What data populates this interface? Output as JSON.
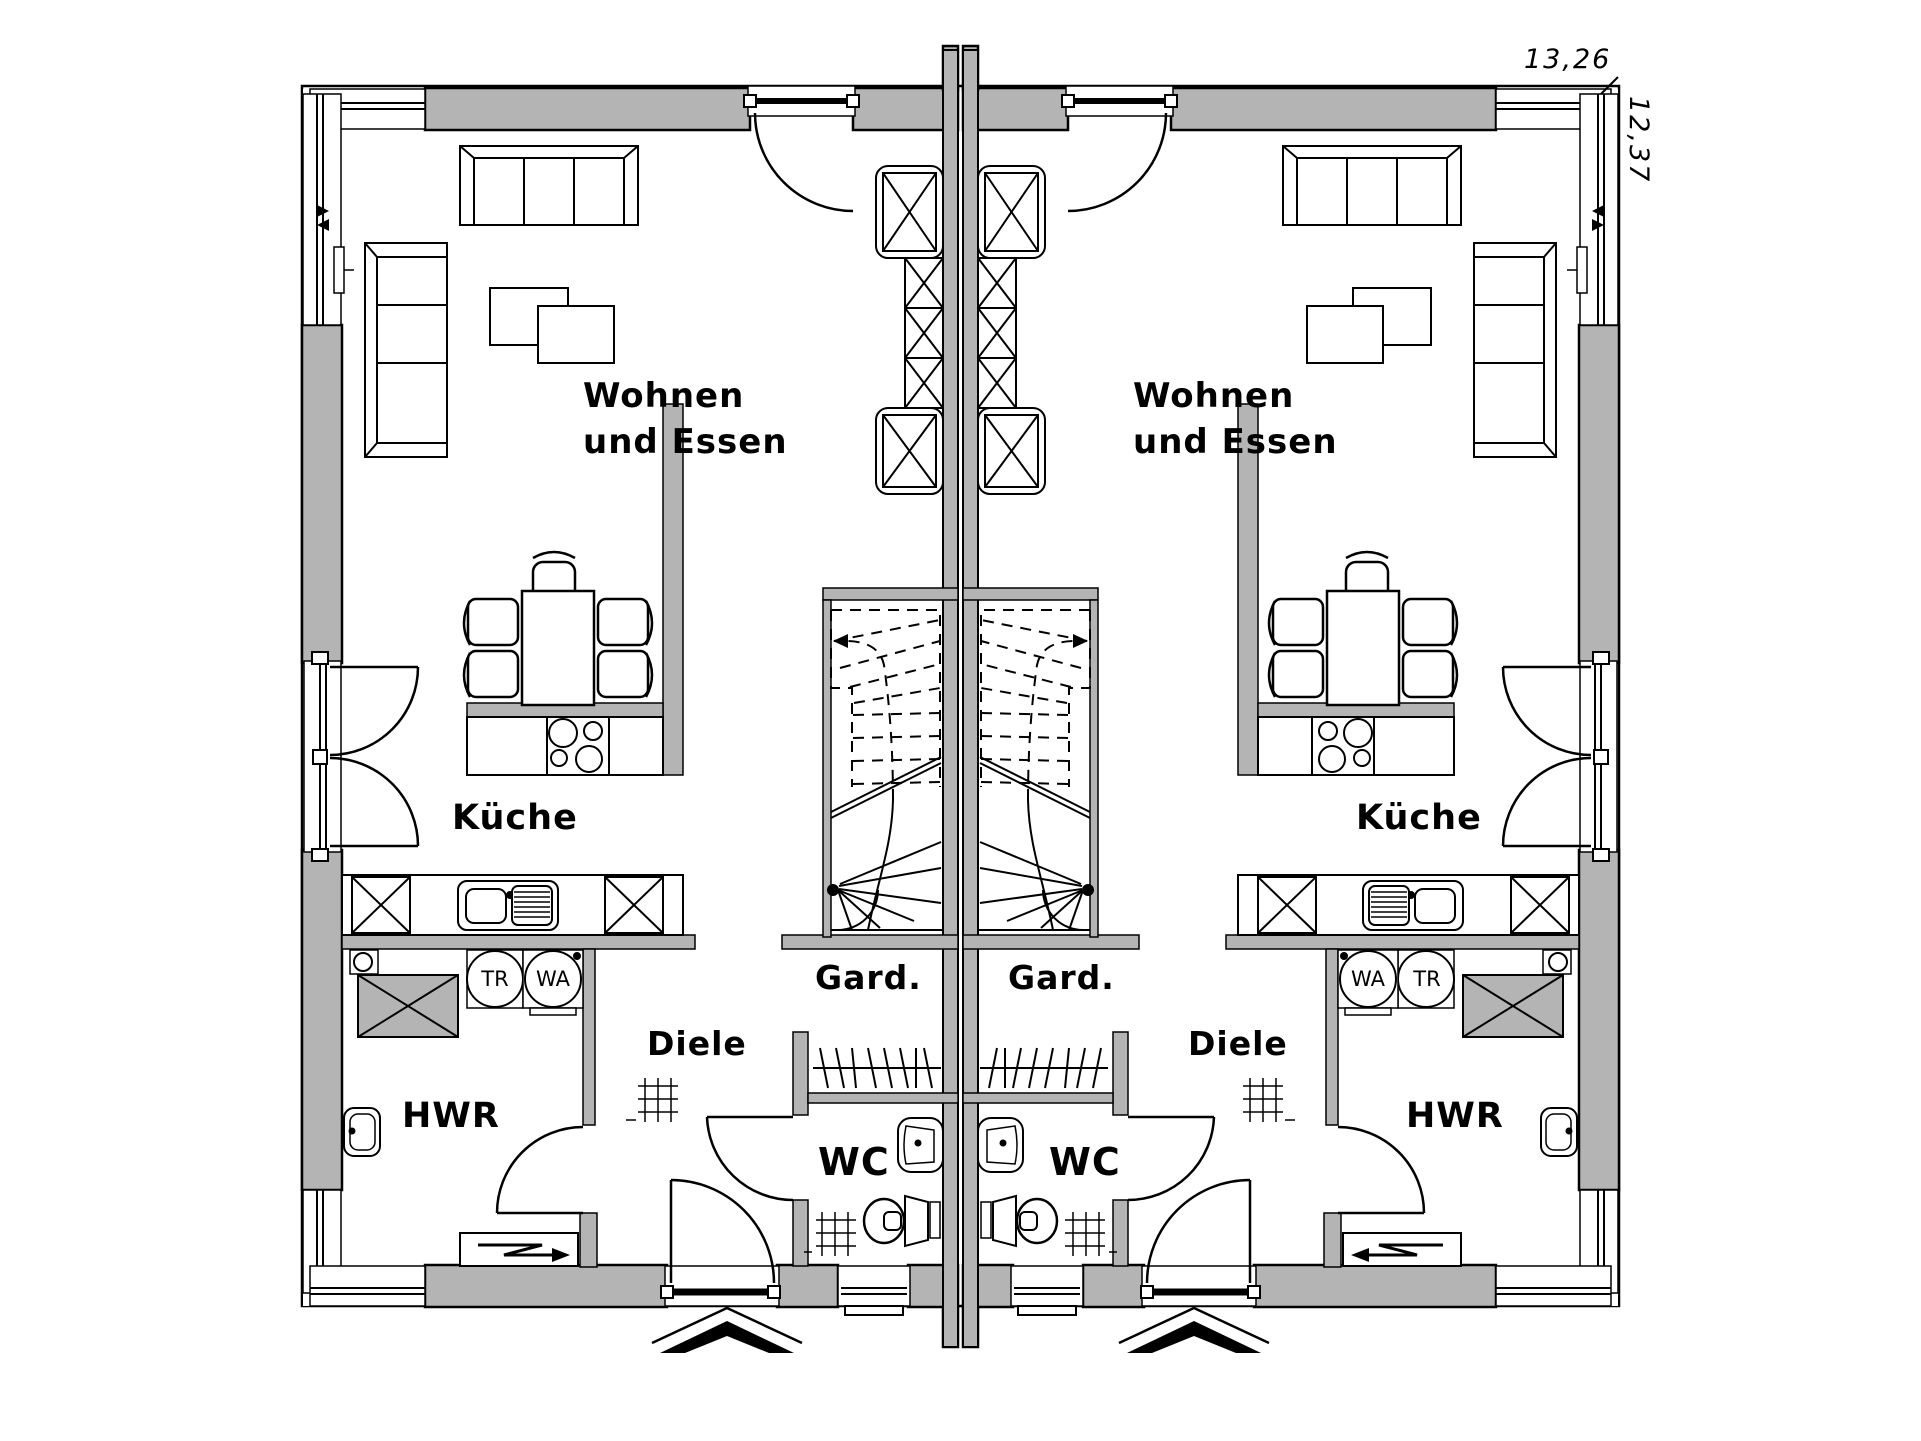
{
  "dimensions": {
    "width": "13,26",
    "depth": "12,37"
  },
  "rooms": {
    "living_line1": "Wohnen",
    "living_line2": "und Essen",
    "kitchen": "Küche",
    "wardrobe": "Gard.",
    "hall": "Diele",
    "wc": "WC",
    "utility": "HWR"
  },
  "appliances": {
    "dryer": "TR",
    "washer": "WA"
  },
  "colors": {
    "wall_fill": "#b4b4b4",
    "line": "#000000",
    "background": "#ffffff"
  }
}
